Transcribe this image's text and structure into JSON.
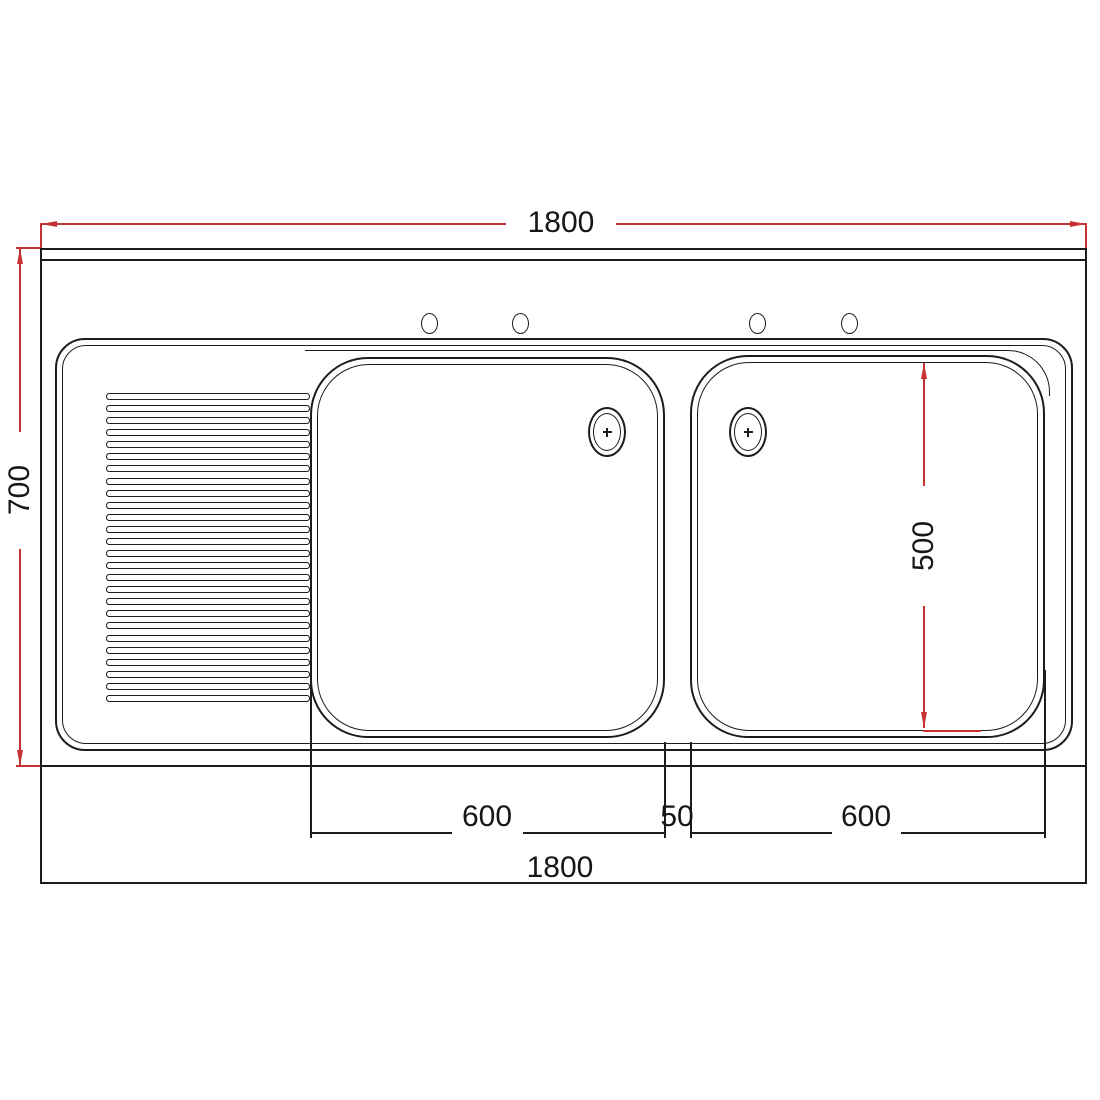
{
  "drawing": {
    "title": "double-bowl-sink-plan-view",
    "type": "technical-drawing",
    "colors": {
      "line": "#1c1c1c",
      "dimension_line": "#c63232",
      "background": "#ffffff"
    },
    "dimensions": {
      "top_width": "1800",
      "overall_depth": "700",
      "bowl_depth": "500",
      "left_bowl_width": "600",
      "bowl_gap": "50",
      "right_bowl_width": "600",
      "bottom_width": "1800"
    },
    "features": {
      "bowl_count": 2,
      "drain_count": 2,
      "tap_hole_count": 4,
      "rib_count": 26
    }
  }
}
